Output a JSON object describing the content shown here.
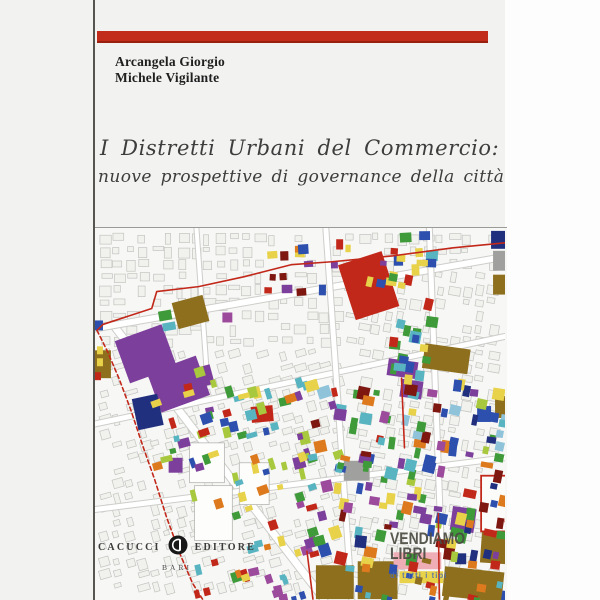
{
  "cover": {
    "authors": [
      "Arcangela Giorgio",
      "Michele Vigilante"
    ],
    "title_line1": "I Distretti Urbani del Commercio:",
    "title_line2": "nuove prospettive di governance della città",
    "accent_color": "#c12d1a"
  },
  "publisher": {
    "name_left": "CACUCCI",
    "name_right": "EDITORE",
    "city": "BARI",
    "logo_color": "#181818"
  },
  "watermark": {
    "line1": "VENDIAMO",
    "line2": "LIBRI",
    "tagline": "di tutti i tipi"
  },
  "map": {
    "bg": "#f7f7f5",
    "boundary_color": "#c2281a",
    "palette": {
      "red": "#c2281a",
      "darkred": "#7d1710",
      "orange": "#dd7a1e",
      "yellow": "#e8d24a",
      "lime": "#a8c83e",
      "green": "#3f9a3a",
      "teal": "#58b4c0",
      "sky": "#8fc3da",
      "blue": "#2d4fad",
      "navy": "#20307e",
      "purple": "#7d3f9c",
      "violet": "#9c4a9c",
      "brown": "#8d6f1e",
      "pink": "#efaeb5",
      "gray": "#a0a09e",
      "white": "#fdfdfc"
    },
    "streets": [
      {
        "pts": [
          [
            18,
            96
          ],
          [
            230,
            372
          ]
        ],
        "w": 7
      },
      {
        "pts": [
          [
            0,
            100
          ],
          [
            412,
            28
          ]
        ],
        "w": 6
      },
      {
        "pts": [
          [
            0,
            196
          ],
          [
            412,
            108
          ]
        ],
        "w": 5
      },
      {
        "pts": [
          [
            232,
            0
          ],
          [
            258,
            372
          ]
        ],
        "w": 5
      },
      {
        "pts": [
          [
            336,
            0
          ],
          [
            350,
            372
          ]
        ],
        "w": 5
      },
      {
        "pts": [
          [
            0,
            282
          ],
          [
            412,
            230
          ]
        ],
        "w": 5
      },
      {
        "pts": [
          [
            102,
            0
          ],
          [
            112,
            140
          ]
        ],
        "w": 4
      }
    ],
    "features": [
      [
        95,
        215,
        35,
        40,
        "white"
      ],
      [
        100,
        258,
        38,
        55,
        "white"
      ],
      [
        145,
        235,
        30,
        42,
        "white"
      ],
      [
        252,
        28,
        46,
        58,
        "red",
        -18
      ],
      [
        26,
        103,
        50,
        45,
        "purple",
        -20
      ],
      [
        58,
        135,
        52,
        42,
        "purple",
        -20
      ],
      [
        100,
        138,
        18,
        20,
        "purple",
        -15
      ],
      [
        294,
        132,
        30,
        17,
        "purple",
        8
      ],
      [
        307,
        152,
        22,
        18,
        "purple",
        8
      ],
      [
        358,
        280,
        24,
        24,
        "purple",
        8
      ],
      [
        74,
        230,
        14,
        15,
        "purple",
        0
      ],
      [
        80,
        70,
        32,
        27,
        "brown",
        -15
      ],
      [
        0,
        122,
        16,
        28,
        "brown",
        0
      ],
      [
        330,
        118,
        46,
        25,
        "brown",
        8
      ],
      [
        400,
        46,
        12,
        20,
        "brown",
        0
      ],
      [
        402,
        168,
        15,
        22,
        "brown",
        0
      ],
      [
        222,
        338,
        38,
        34,
        "brown",
        0
      ],
      [
        264,
        334,
        40,
        38,
        "brown",
        0
      ],
      [
        350,
        342,
        60,
        30,
        "brown",
        6
      ],
      [
        388,
        300,
        26,
        36,
        "brown",
        4
      ],
      [
        400,
        22,
        12,
        20,
        "gray",
        0
      ],
      [
        398,
        2,
        14,
        18,
        "navy",
        0
      ],
      [
        250,
        233,
        26,
        20,
        "gray",
        0
      ],
      [
        40,
        168,
        26,
        32,
        "navy",
        -12
      ],
      [
        384,
        178,
        14,
        16,
        "blue",
        0
      ],
      [
        157,
        178,
        22,
        16,
        "red",
        -5
      ],
      [
        300,
        325,
        48,
        17,
        "pink",
        0
      ],
      [
        306,
        344,
        44,
        12,
        "yellow",
        0
      ],
      [
        362,
        326,
        11,
        11,
        "navy",
        0
      ],
      [
        388,
        248,
        30,
        56,
        "outline-red",
        0
      ],
      [
        64,
        82,
        13,
        10,
        "green",
        -10
      ],
      [
        68,
        94,
        13,
        8,
        "teal",
        -10
      ],
      [
        128,
        84,
        10,
        10,
        "violet",
        0
      ],
      [
        0,
        92,
        8,
        10,
        "blue",
        0
      ],
      [
        2,
        118,
        6,
        8,
        "yellow",
        0
      ],
      [
        2,
        130,
        6,
        8,
        "yellow",
        0
      ],
      [
        0,
        144,
        6,
        8,
        "red",
        0
      ]
    ],
    "clusters": [
      {
        "x": 205,
        "y": 150,
        "w": 210,
        "h": 180,
        "n": 150,
        "smin": 5,
        "smax": 13,
        "colors": [
          "green",
          "green",
          "teal",
          "blue",
          "red",
          "orange",
          "violet",
          "lime",
          "yellow",
          "darkred",
          "navy",
          "purple",
          "sky",
          "green",
          "teal"
        ]
      },
      {
        "x": 55,
        "y": 135,
        "w": 150,
        "h": 130,
        "n": 55,
        "smin": 5,
        "smax": 12,
        "colors": [
          "yellow",
          "teal",
          "lime",
          "red",
          "blue",
          "purple",
          "orange",
          "yellow",
          "green"
        ]
      },
      {
        "x": 170,
        "y": 8,
        "w": 130,
        "h": 52,
        "n": 22,
        "smin": 5,
        "smax": 11,
        "colors": [
          "yellow",
          "darkred",
          "teal",
          "blue",
          "purple",
          "red",
          "orange"
        ]
      },
      {
        "x": 295,
        "y": 0,
        "w": 38,
        "h": 150,
        "n": 30,
        "smin": 6,
        "smax": 12,
        "colors": [
          "green",
          "blue",
          "teal",
          "yellow",
          "red",
          "navy",
          "green"
        ]
      },
      {
        "x": 95,
        "y": 270,
        "w": 120,
        "h": 100,
        "n": 28,
        "smin": 5,
        "smax": 11,
        "colors": [
          "orange",
          "teal",
          "green",
          "red",
          "yellow",
          "blue",
          "violet"
        ]
      },
      {
        "x": 215,
        "y": 330,
        "w": 200,
        "h": 42,
        "n": 25,
        "smin": 5,
        "smax": 10,
        "colors": [
          "green",
          "blue",
          "red",
          "teal",
          "brown",
          "orange"
        ]
      }
    ],
    "boundary": [
      {
        "pts": [
          [
            412,
            14
          ],
          [
            360,
            19
          ],
          [
            300,
            27
          ],
          [
            238,
            33
          ],
          [
            197,
            36
          ],
          [
            150,
            48
          ],
          [
            104,
            58
          ],
          [
            62,
            63
          ],
          [
            57,
            80
          ],
          [
            8,
            96
          ],
          [
            2,
            102
          ]
        ],
        "dash": false
      },
      {
        "pts": [
          [
            2,
            102
          ],
          [
            12,
            122
          ],
          [
            24,
            150
          ],
          [
            36,
            182
          ],
          [
            48,
            218
          ],
          [
            60,
            252
          ],
          [
            72,
            290
          ],
          [
            86,
            328
          ],
          [
            98,
            356
          ],
          [
            108,
            372
          ]
        ],
        "dash": true
      },
      {
        "pts": [
          [
            308,
            150
          ],
          [
            311,
            220
          ]
        ],
        "dash": false
      },
      {
        "pts": [
          [
            213,
            324
          ],
          [
            219,
            372
          ]
        ],
        "dash": false
      },
      {
        "pts": [
          [
            345,
            286
          ],
          [
            346,
            372
          ]
        ],
        "dash": false
      }
    ]
  }
}
